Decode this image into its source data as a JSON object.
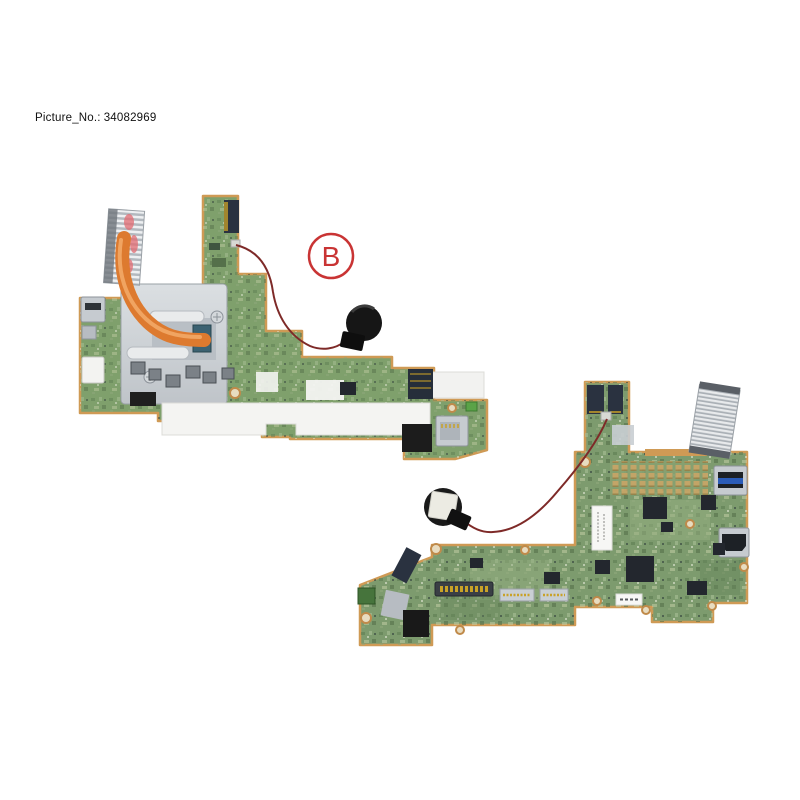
{
  "photo": {
    "picture_no_label": "Picture_No.:",
    "picture_no_value": "34082969",
    "callout_label": "B",
    "colors": {
      "background": "#ffffff",
      "callout_red": "#c93434",
      "pcb_green_top": "#7fa06c",
      "pcb_green_bottom": "#7d9b6e",
      "copper_edge": "#cf9a55",
      "heatpipe_orange": "#dd7a2f",
      "shield_silver": "#ccd1d5",
      "battery_black": "#161616",
      "battery_sticker_white": "#ecebe3",
      "wire_dark_red": "#7e2a28",
      "usb_blue": "#2b5cb8"
    }
  }
}
